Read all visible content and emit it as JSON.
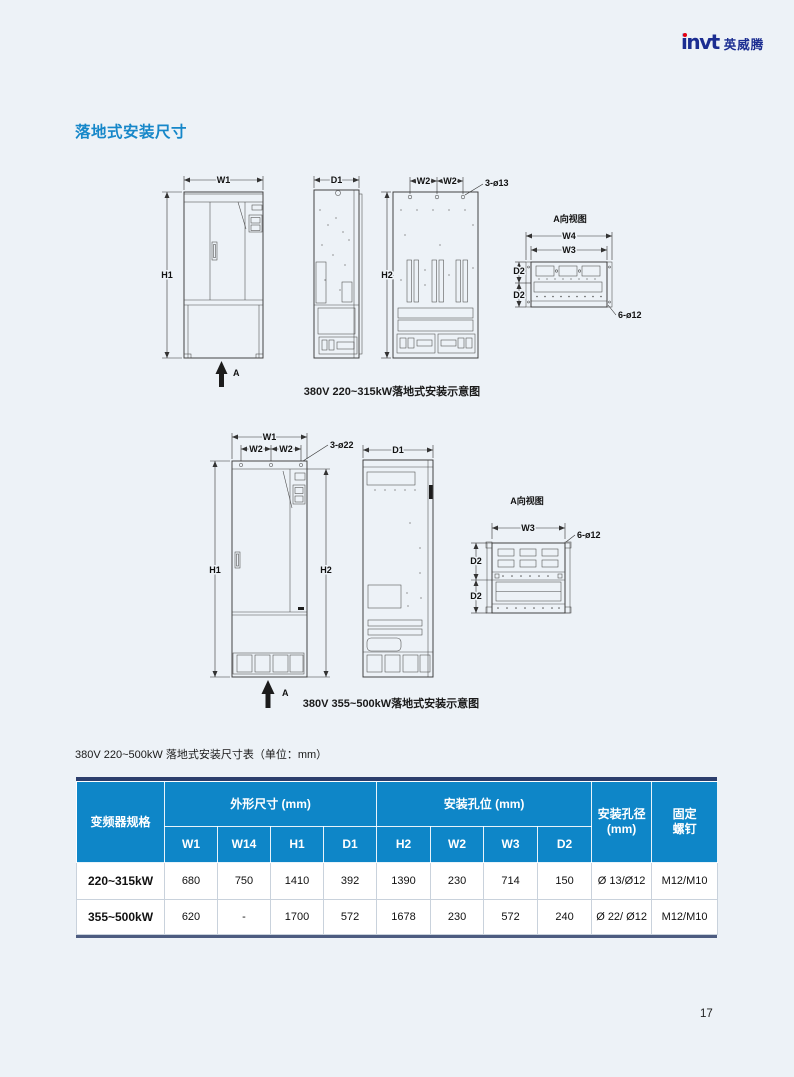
{
  "meta": {
    "page_number": "17"
  },
  "logo": {
    "latin": "invt",
    "cn": "英威腾"
  },
  "section": {
    "title": "落地式安装尺寸"
  },
  "figure1": {
    "caption": "380V 220~315kW落地式安装示意图",
    "view_label": "A向视图",
    "dim_w1": "W1",
    "dim_h1": "H1",
    "dim_d1": "D1",
    "dim_h2": "H2",
    "dim_w2": "W2",
    "dim_w3": "W3",
    "dim_w4": "W4",
    "dim_d2": "D2",
    "hole_top": "3-ø13",
    "hole_view": "6-ø12",
    "arrow": "A"
  },
  "figure2": {
    "caption": "380V 355~500kW落地式安装示意图",
    "view_label": "A向视图",
    "dim_w1": "W1",
    "dim_h1": "H1",
    "dim_d1": "D1",
    "dim_h2": "H2",
    "dim_w2": "W2",
    "dim_w3": "W3",
    "dim_d2": "D2",
    "hole_top": "3-ø22",
    "hole_view": "6-ø12",
    "arrow": "A"
  },
  "table": {
    "title": "380V 220~500kW 落地式安装尺寸表（单位：mm）",
    "header": {
      "spec": "变频器规格",
      "group_outline": "外形尺寸 (mm)",
      "group_holes": "安装孔位 (mm)",
      "sub": [
        "W1",
        "W14",
        "H1",
        "D1",
        "H2",
        "W2",
        "W3",
        "D2"
      ],
      "hole_dia": "安装孔径\n(mm)",
      "screw": "固定\n螺钉"
    },
    "rows": [
      {
        "spec": "220~315kW",
        "values": [
          "680",
          "750",
          "1410",
          "392",
          "1390",
          "230",
          "714",
          "150",
          "Ø 13/Ø12",
          "M12/M10"
        ]
      },
      {
        "spec": "355~500kW",
        "values": [
          "620",
          "-",
          "1700",
          "572",
          "1678",
          "230",
          "572",
          "240",
          "Ø 22/ Ø12",
          "M12/M10"
        ]
      }
    ]
  },
  "colors": {
    "page_bg": "#edf2f7",
    "accent_blue": "#1687c9",
    "table_header_blue": "#0e86c8",
    "navy_border_top": "#2c3e6d",
    "navy_border_bottom": "#4d5c80",
    "logo_navy": "#1b2d91",
    "logo_red": "#e60012"
  }
}
